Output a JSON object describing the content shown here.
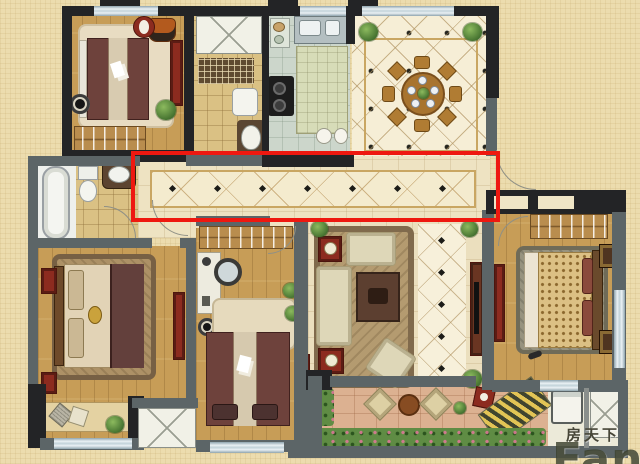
{
  "watermark": {
    "cn": "房天下",
    "en": "Fang"
  },
  "annotation": {
    "name": "corridor-highlight-box",
    "color": "#ee1810"
  },
  "palette": {
    "page_background": "#ecdcae",
    "wall_dark": "#232426",
    "wall_gray": "#5c6567",
    "window": "#cfdde4",
    "wood_floor": "#c79d57",
    "cream_tile": "#eee3c2",
    "diamond_tile": "#f6eed6",
    "kitchen_floor": "#ccd6cb",
    "bathroom_tile": "#dac184",
    "stone_floor": "#dcb191",
    "greenery": "#5f8c44",
    "furniture_red": "#8c2b1f",
    "bed_maroon": "#6e423c",
    "highlight_red": "#ee1810"
  }
}
